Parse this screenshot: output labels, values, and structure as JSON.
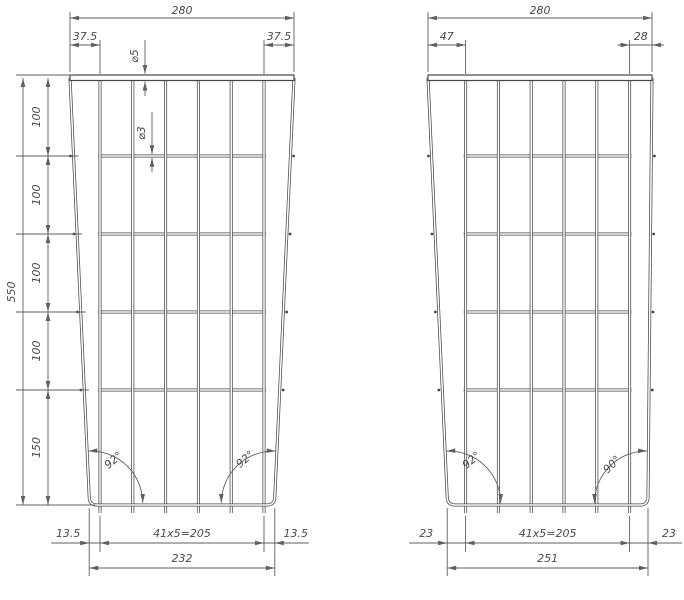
{
  "drawing": {
    "background": "#ffffff",
    "line_color": "#474747",
    "dim_line_color": "#5f5f5f",
    "text_color": "#4a4a4a",
    "panels": [
      {
        "id": "left-grid-panel",
        "top_width": "280",
        "top_offset_left": "37.5",
        "top_offset_right": "37.5",
        "top_wire_diameter": "⌀5",
        "mesh_wire_diameter": "⌀3",
        "total_height": "550",
        "row_spacings": [
          "100",
          "100",
          "100",
          "100",
          "150"
        ],
        "bottom_offset_left": "13.5",
        "bottom_pitch": "41x5=205",
        "bottom_offset_right": "13.5",
        "bottom_width": "232",
        "angle_left": "92°",
        "angle_right": "92°"
      },
      {
        "id": "right-grid-panel",
        "top_width": "280",
        "top_offset_left": "47",
        "top_offset_right": "28",
        "bottom_offset_left": "23",
        "bottom_pitch": "41x5=205",
        "bottom_offset_right": "23",
        "bottom_width": "251",
        "angle_left": "92°",
        "angle_right": "90°"
      }
    ]
  }
}
